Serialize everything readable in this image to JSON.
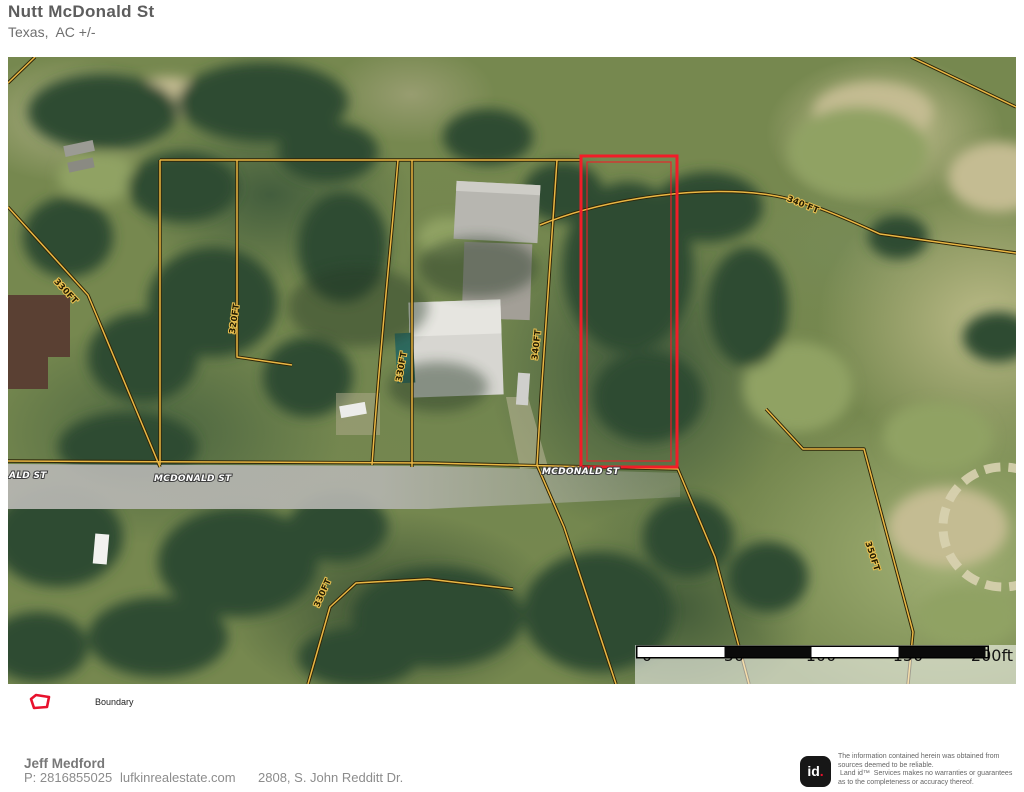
{
  "header": {
    "title": "Nutt McDonald St",
    "subtitle": "Texas,  AC +/-"
  },
  "map": {
    "boundary_color": "#f11d28",
    "parcel_line_color": "#eab744",
    "road_labels": [
      {
        "text": "ALD ST"
      },
      {
        "text": "MCDONALD ST"
      },
      {
        "text": "MCDONALD ST"
      }
    ],
    "dimension_labels": [
      {
        "text": "330FT"
      },
      {
        "text": "320FT"
      },
      {
        "text": "330FT"
      },
      {
        "text": "340FT"
      },
      {
        "text": "340 FT"
      },
      {
        "text": "350FT"
      },
      {
        "text": "330FT"
      }
    ],
    "scale_bar": {
      "labels": [
        "0",
        "50",
        "100",
        "150",
        "200ft"
      ],
      "segment_colors": [
        "#ffffff",
        "#0a0a0a",
        "#ffffff",
        "#0a0a0a"
      ]
    }
  },
  "legend": {
    "items": [
      {
        "label": "Boundary",
        "color": "#e8112d"
      }
    ]
  },
  "footer": {
    "agent_name": "Jeff Medford",
    "phone": "P: 2816855025",
    "website": "lufkinrealestate.com",
    "address": "2808, S. John Redditt Dr."
  },
  "disclaimer": {
    "logo_text": "id",
    "logo_dot": ".",
    "line1": "The information contained herein was obtained from",
    "line2": "sources deemed to be reliable.",
    "line3": " Land id™  Services makes no warranties or guarantees",
    "line4": "as to the completeness or accuracy thereof."
  }
}
